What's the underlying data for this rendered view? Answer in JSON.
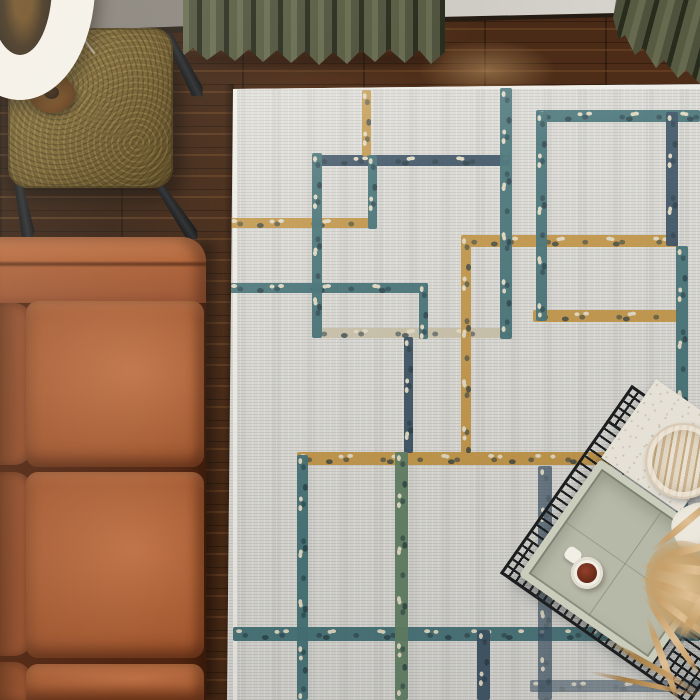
{
  "scene": {
    "description": "Overhead photograph of a living room corner: an ivory area rug with distressed overlapping rectangle pattern, a cognac leather sofa, a brass etched side table with a drum-shade lamp, olive velvet curtains, dark walnut plank flooring, and a black wire-frame coffee table holding trays, a striped stone plate, a mug of coffee and dried pampas grass.",
    "objects": [
      {
        "name": "wood-floor",
        "label": "Dark walnut plank floor"
      },
      {
        "name": "wall",
        "label": "Gray wall with baseboard"
      },
      {
        "name": "curtain-left",
        "label": "Olive green pleated curtain (top left)"
      },
      {
        "name": "curtain-right",
        "label": "Olive green pleated curtain (top right)"
      },
      {
        "name": "area-rug",
        "label": "Ivory rug with teal, navy, gold and green overlapping rectangles"
      },
      {
        "name": "brass-side-table",
        "label": "Brass side table with engraved swirl top and black splayed legs"
      },
      {
        "name": "floor-lamp",
        "label": "Cream drum-shade lamp seen from above"
      },
      {
        "name": "leather-sofa",
        "label": "Cognac leather sofa with three seat cushions"
      },
      {
        "name": "wire-coffee-table",
        "label": "Black geometric wire coffee table with glass top"
      },
      {
        "name": "serving-board",
        "label": "Cream linen-textured board"
      },
      {
        "name": "stone-plate",
        "label": "Travertine striped round plate"
      },
      {
        "name": "serving-tray",
        "label": "Sage green rectangular tray"
      },
      {
        "name": "coffee-mug",
        "label": "White mug with coffee"
      },
      {
        "name": "pampas-grass",
        "label": "Dried tan pampas grass decor"
      }
    ]
  },
  "palette": {
    "wood": "#512f19",
    "wall-dark": "#7b766f",
    "wall-light": "#dbd8d1",
    "baseboard": "#241b13",
    "curtain": "#4e523c",
    "curtain-light": "#666b4f",
    "curtain-dark": "#282c1d",
    "brass": "#857031",
    "shade": "#e9e5db",
    "lamp-inner": "#1e1711",
    "sofa": "#a55a31",
    "sofa-light": "#c27547",
    "sofa-deep": "#4f2410",
    "rug": "#d8d7d2",
    "rug-light": "#eceae5",
    "teal": "#3c6b70",
    "teal-dark": "#24454f",
    "navy": "#32495c",
    "gold": "#bd8f3e",
    "green": "#5a7a5d",
    "cream": "#ddd5bd",
    "wire": "#1b1d1f",
    "sage": "#b7b9a8",
    "sage-light": "#cbcdbc",
    "board": "#e5e1d7",
    "plate-tan": "#c3a77f",
    "plate-cream": "#e8e0d0",
    "mug": "#f1eee6",
    "coffee": "#6f2d1c",
    "pampas": "#c7a06b",
    "pampas-dark": "#a57f49"
  }
}
